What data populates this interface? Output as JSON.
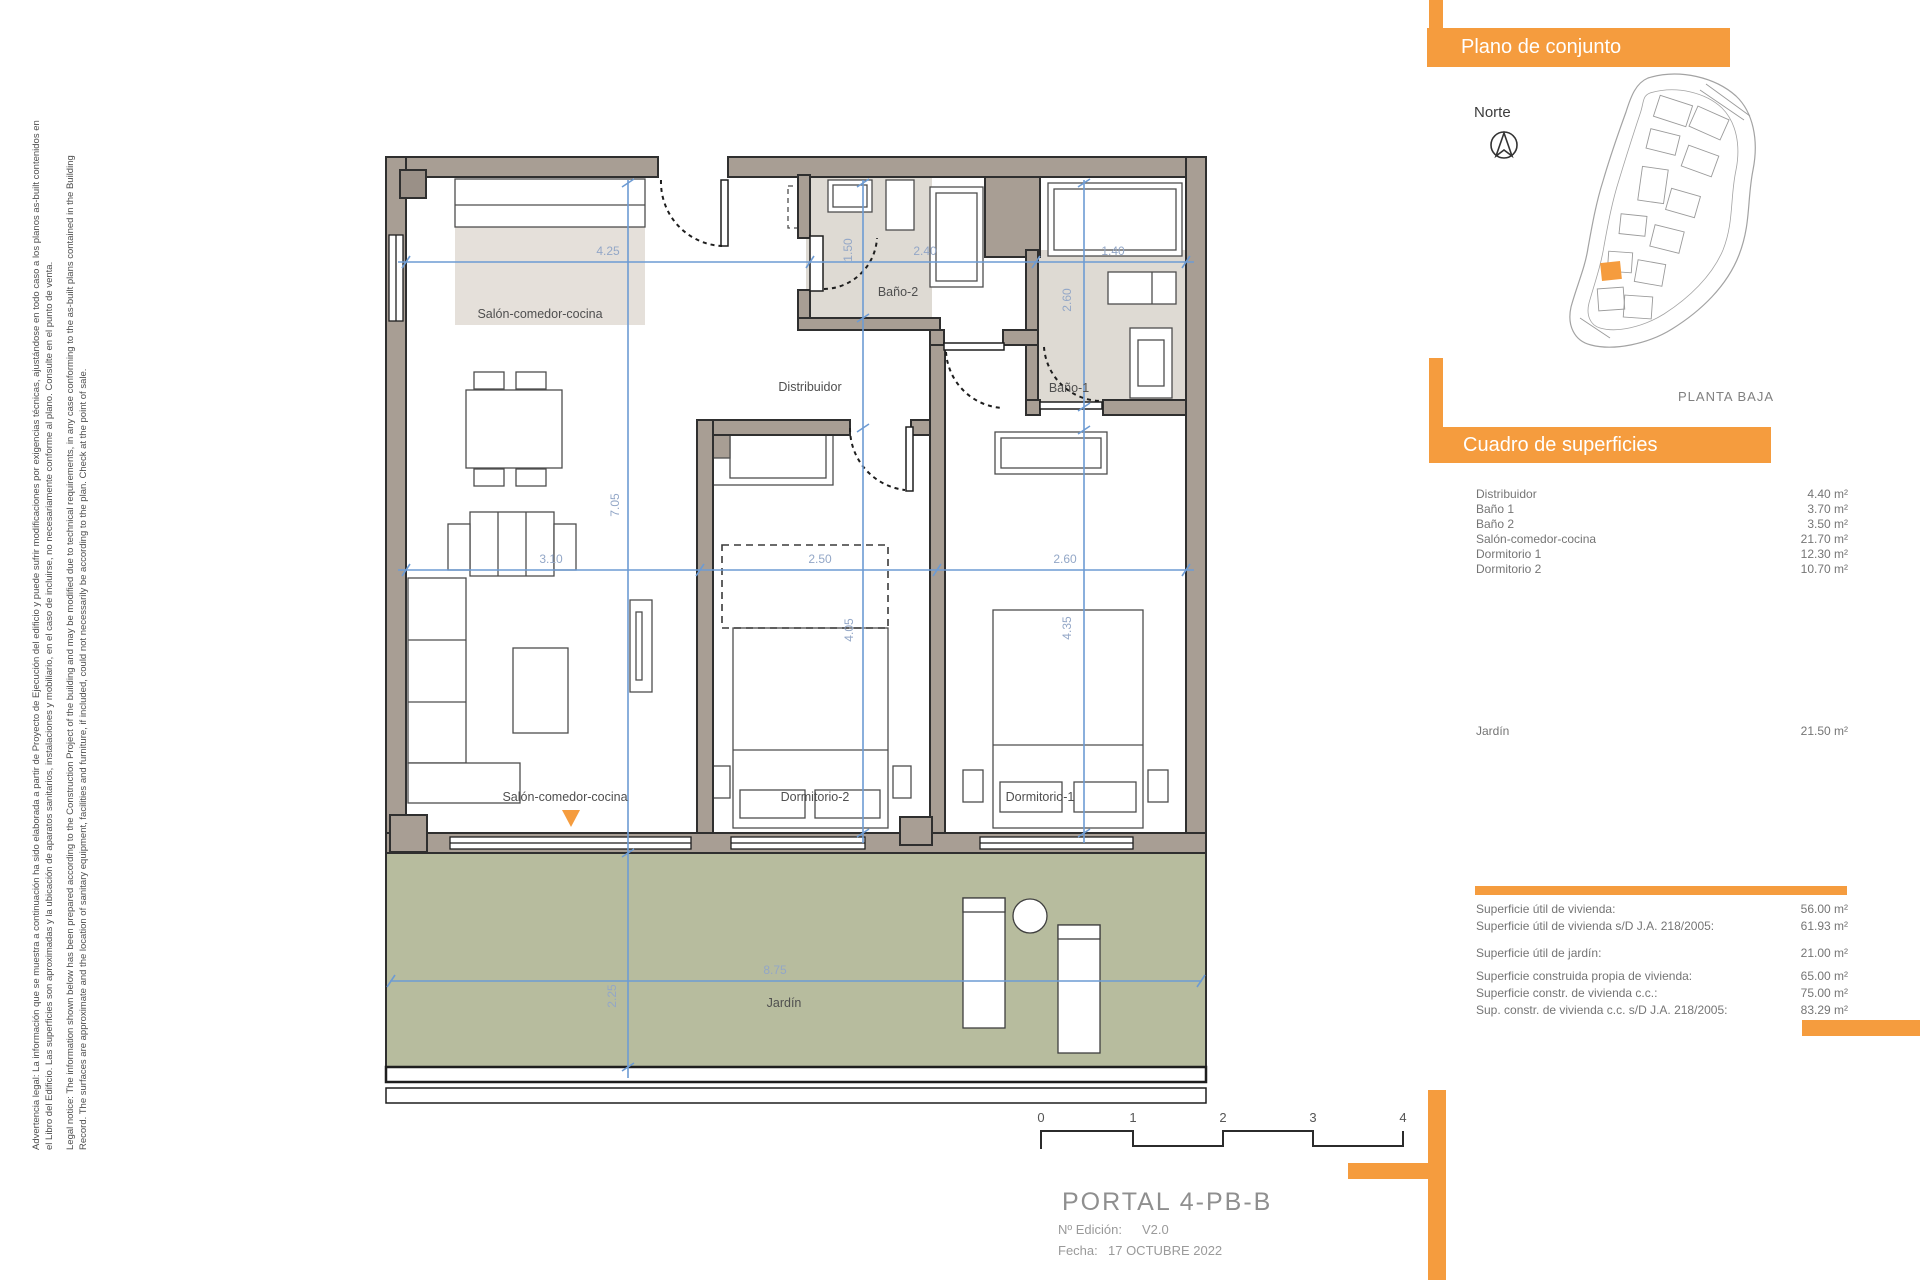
{
  "disclaimer": {
    "line1": "Advertencia legal: La información que se muestra a continuación ha sido elaborada a partir de Proyecto de Ejecución del edificio y puede sufrir modificaciones por exigencias técnicas, ajustándose en todo caso a los planos as-built contenidos en",
    "line2": "el Libro del Edificio. Las superficies son aproximadas y la ubicación de aparatos sanitarios, instalaciones y mobiliario, en el caso de incluirse, no necesariamente conforme al plano. Consulte en el punto de venta.",
    "line3": "Legal notice: The information shown below has been prepared according to the Construction Project of the building and may be modified due to technical requirements, in any case conforming to the as-built plans contained in the Building",
    "line4": "Record. The surfaces are approximate and the location of sanitary equipment, facilities and furniture, if included, could not necessarily be according to the plan. Check at the point of sale."
  },
  "site_panel": {
    "title": "Plano de conjunto",
    "north_label": "Norte",
    "floor_label": "PLANTA BAJA"
  },
  "surfaces_panel": {
    "title": "Cuadro de superficies",
    "rows": [
      {
        "label": "Distribuidor",
        "value": "4.40 m²"
      },
      {
        "label": "Baño 1",
        "value": "3.70 m²"
      },
      {
        "label": "Baño 2",
        "value": "3.50 m²"
      },
      {
        "label": "Salón-comedor-cocina",
        "value": "21.70 m²"
      },
      {
        "label": "Dormitorio 1",
        "value": "12.30 m²"
      },
      {
        "label": "Dormitorio 2",
        "value": "10.70 m²"
      }
    ],
    "garden_row": {
      "label": "Jardín",
      "value": "21.50 m²"
    },
    "summary_rows": [
      {
        "label": "Superficie útil de vivienda:",
        "value": "56.00 m²"
      },
      {
        "label": "Superficie útil de vivienda s/D J.A. 218/2005:",
        "value": "61.93 m²"
      },
      {
        "label": "Superficie útil de jardín:",
        "value": "21.00 m²"
      },
      {
        "label": "Superficie construida propia de vivienda:",
        "value": "65.00 m²"
      },
      {
        "label": "Superficie constr. de vivienda c.c.:",
        "value": "75.00 m²"
      },
      {
        "label": "Sup. constr. de vivienda c.c. s/D J.A. 218/2005:",
        "value": "83.29 m²"
      }
    ]
  },
  "floor_plan": {
    "rooms": {
      "salon": "Salón-comedor-cocina",
      "distribuidor": "Distribuidor",
      "bano2": "Baño-2",
      "bano1": "Baño-1",
      "dorm2": "Dormitorio-2",
      "dorm1": "Dormitorio-1",
      "jardin": "Jardín"
    },
    "dimensions": {
      "top": [
        "4.25",
        "2.40",
        "1.40"
      ],
      "middle": [
        "3.10",
        "2.50",
        "2.60"
      ],
      "salon_height": "7.05",
      "bano2_width": "1.50",
      "dorm2_height": "4.05",
      "bano1_height": "2.60",
      "dorm1_height": "4.35",
      "garden_width": "8.75",
      "garden_depth": "2.25"
    }
  },
  "scale_bar": {
    "ticks": [
      "0",
      "1",
      "2",
      "3",
      "4"
    ]
  },
  "title_block": {
    "portal": "PORTAL 4-PB-B",
    "edition_label": "Nº Edición:",
    "edition_value": "V2.0",
    "date_label": "Fecha:",
    "date_value": "17 OCTUBRE 2022"
  },
  "colors": {
    "accent_orange": "#F59C3E",
    "wall_taupe": "#A89E94",
    "garden_green": "#B7BC9E",
    "dimension_blue": "#6D9BD3",
    "bath_floor": "#DEDAD3",
    "kitchen_beige": "#E5E0DA"
  }
}
